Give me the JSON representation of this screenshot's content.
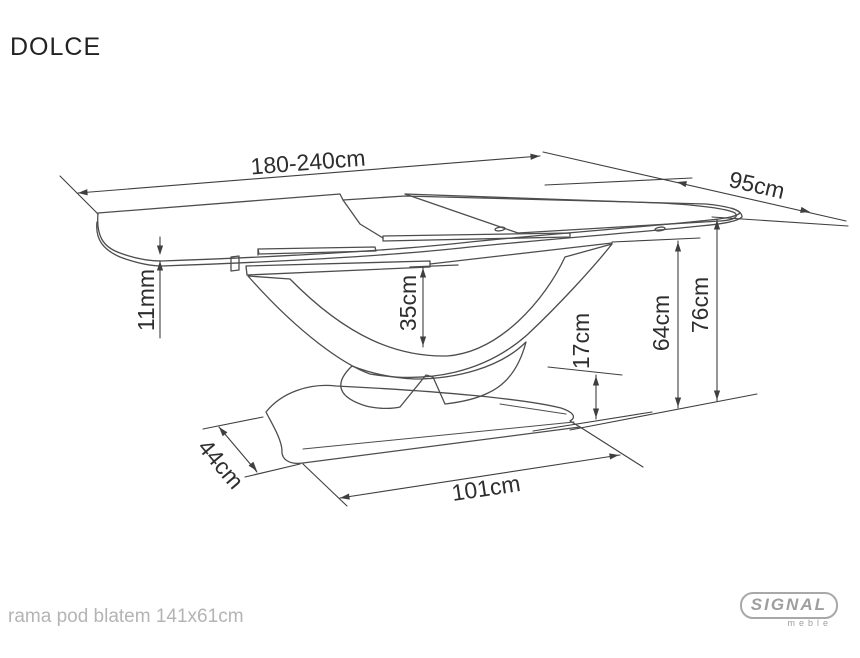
{
  "title": "DOLCE",
  "drawing": {
    "dimensions": {
      "length": "180-240cm",
      "depth": "95cm",
      "top_thickness": "11mm",
      "arch_clearance": "35cm",
      "base_height": "17cm",
      "frame_height": "64cm",
      "total_height": "76cm",
      "base_depth": "44cm",
      "base_length": "101cm"
    }
  },
  "footer": {
    "frame_note": "rama pod blatem 141x61cm"
  },
  "logo": {
    "brand": "SIGNAL",
    "subtitle": "meble"
  },
  "colors": {
    "line": "#4d4d4d",
    "dimension_line": "#3f3f3f",
    "text": "#2e2e2e",
    "muted_text": "#b4b4b4",
    "logo_gray": "#9e9e9e",
    "shade_light": "#ececec",
    "background": "#ffffff"
  }
}
